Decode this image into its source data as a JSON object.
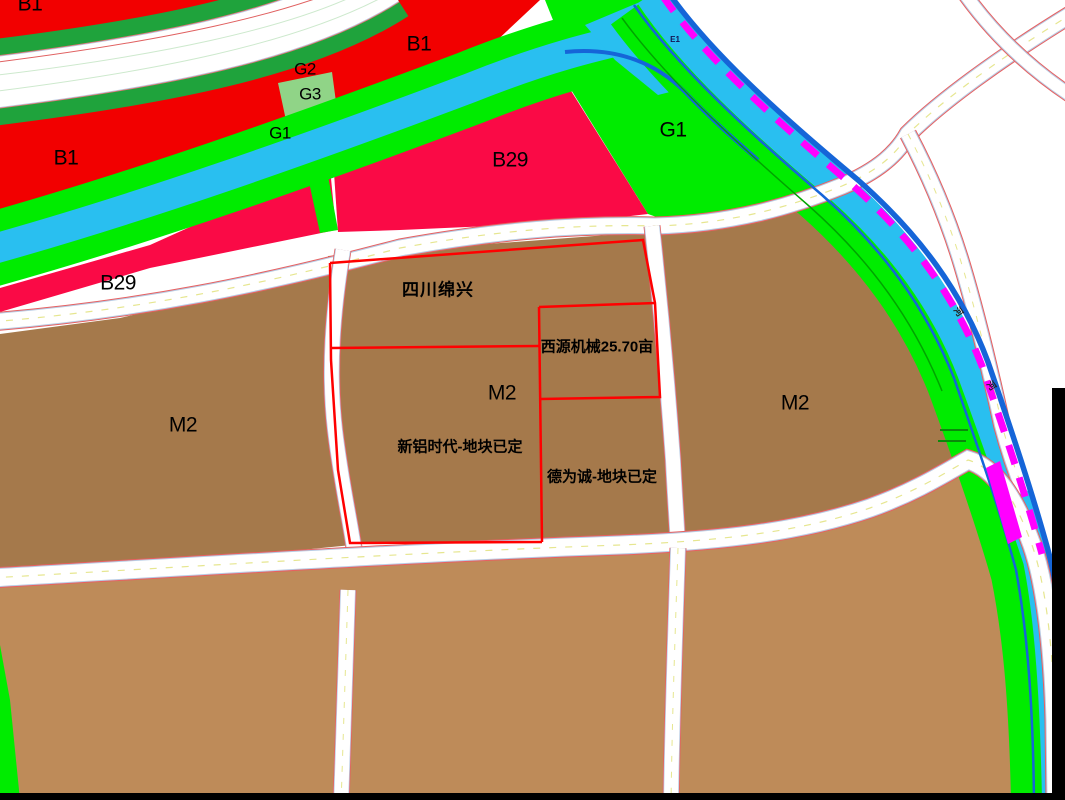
{
  "map": {
    "description": "Urban land-use zoning map with parcels, canal, river and roads",
    "labels": {
      "b1_topleft": {
        "text": "B1"
      },
      "b1_left": {
        "text": "B1"
      },
      "b1_mid": {
        "text": "B1"
      },
      "g2": {
        "text": "G2"
      },
      "g3": {
        "text": "G3"
      },
      "g1_canal": {
        "text": "G1"
      },
      "g1_parcel": {
        "text": "G1"
      },
      "e1": {
        "text": "E1"
      },
      "b29_main": {
        "text": "B29"
      },
      "b29_left": {
        "text": "B29"
      },
      "m2_left": {
        "text": "M2"
      },
      "m2_center": {
        "text": "M2"
      },
      "m2_right": {
        "text": "M2"
      },
      "parcel_sichuan": {
        "text": "四川绵兴"
      },
      "parcel_xiyuan": {
        "text": "西源机械25.70亩"
      },
      "parcel_xinlv": {
        "text": "新铝时代-地块已定"
      },
      "parcel_dewei": {
        "text": "德为诚-地块已定"
      },
      "river_glyph_1": {
        "text": "河"
      },
      "river_glyph_2": {
        "text": "河"
      }
    },
    "colors": {
      "b1_red": "#F20000",
      "b29_crimson": "#FA0A46",
      "forest_green": "#1FA33C",
      "bright_green": "#00EC00",
      "light_green_g3": "#90D487",
      "water_cyan": "#29BFF0",
      "river_bank_blue": "#1565D8",
      "boundary_magenta": "#FF00FF",
      "industrial_brown": "#A5794B",
      "industrial_tan": "#BE8B59",
      "parcel_outline_red": "#FF0000",
      "road_white": "#FFFFFF"
    }
  }
}
